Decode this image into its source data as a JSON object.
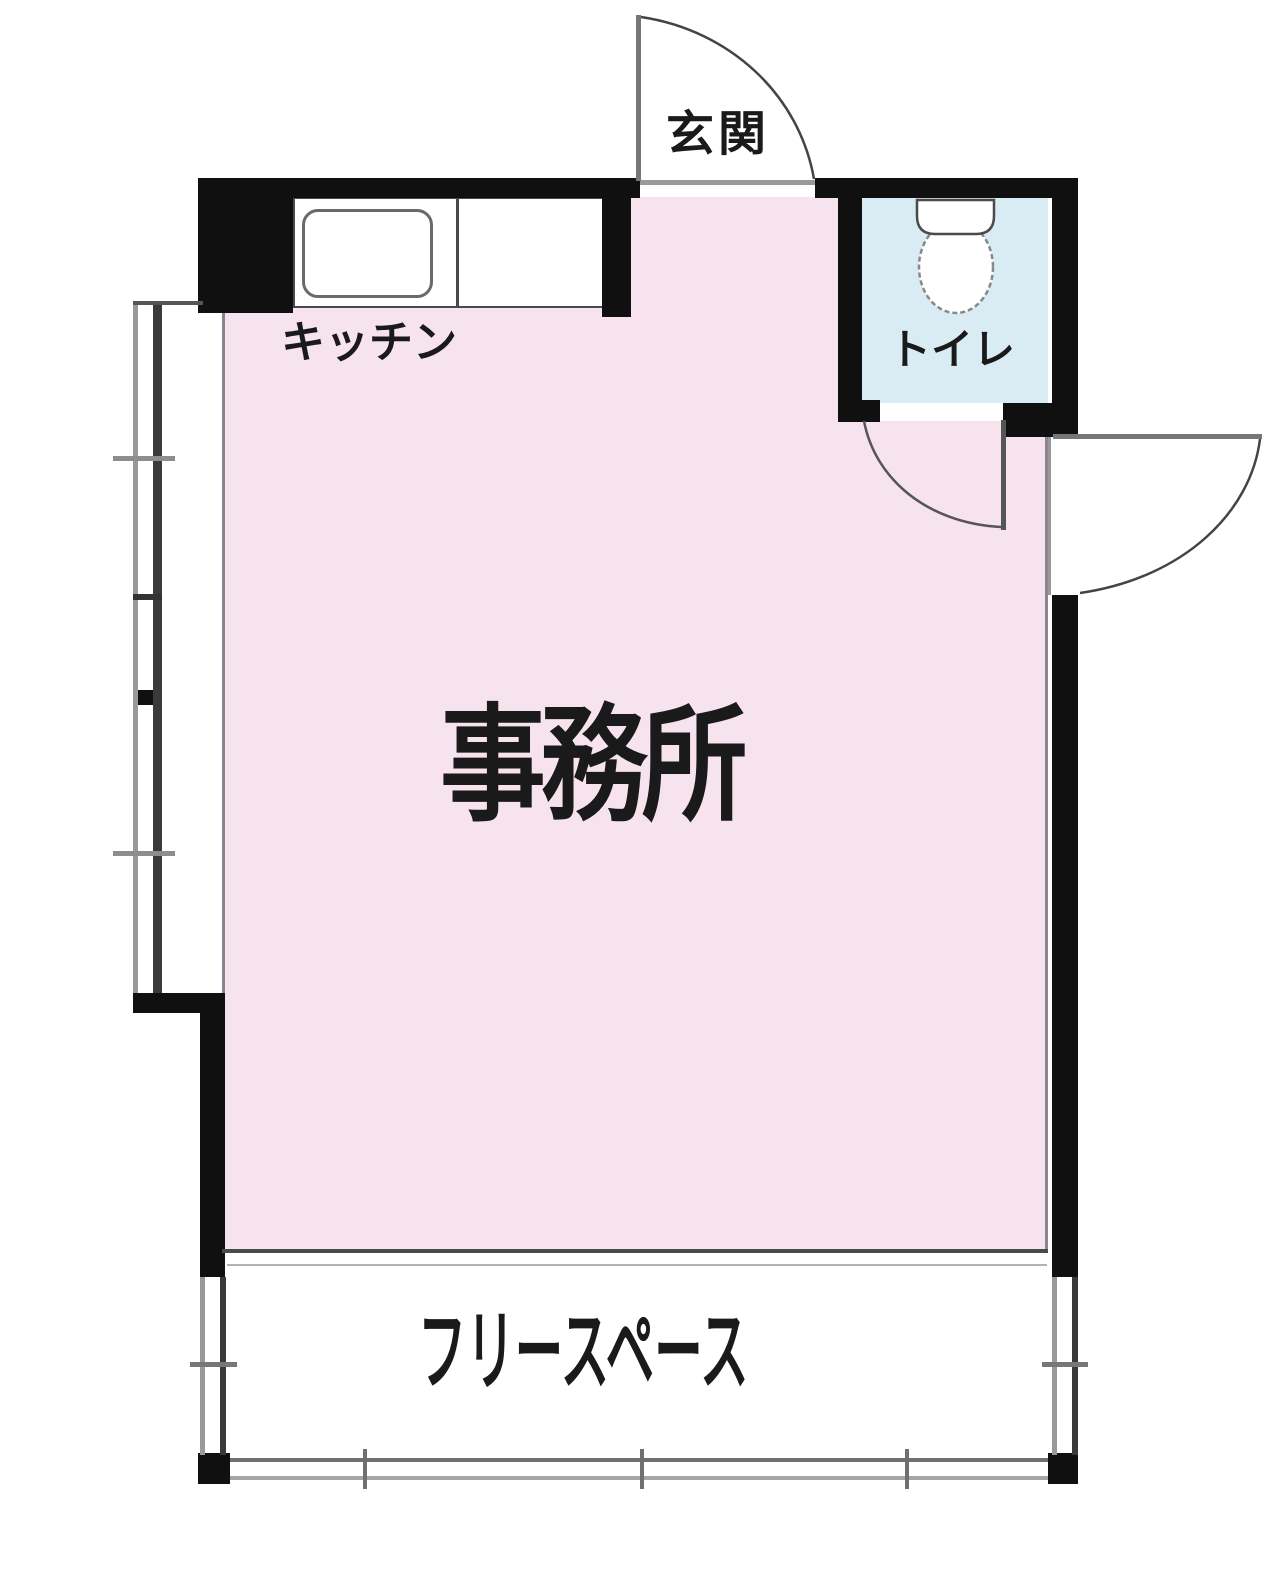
{
  "plan_title": "room-floor-plan",
  "rooms": {
    "entrance": {
      "label": "玄関"
    },
    "kitchen": {
      "label": "キッチン"
    },
    "toilet": {
      "label": "トイレ"
    },
    "office": {
      "label": "事務所"
    },
    "free_space": {
      "label": "フリースペース"
    }
  },
  "colors": {
    "office_fill": "#f6e3ed",
    "toilet_fill": "#d9ecf4",
    "wall": "#101010",
    "window_frame_dark": "#3a3a3a",
    "window_frame_light": "#999999",
    "door_line": "#777777",
    "counter_border": "#4a4a4a"
  }
}
